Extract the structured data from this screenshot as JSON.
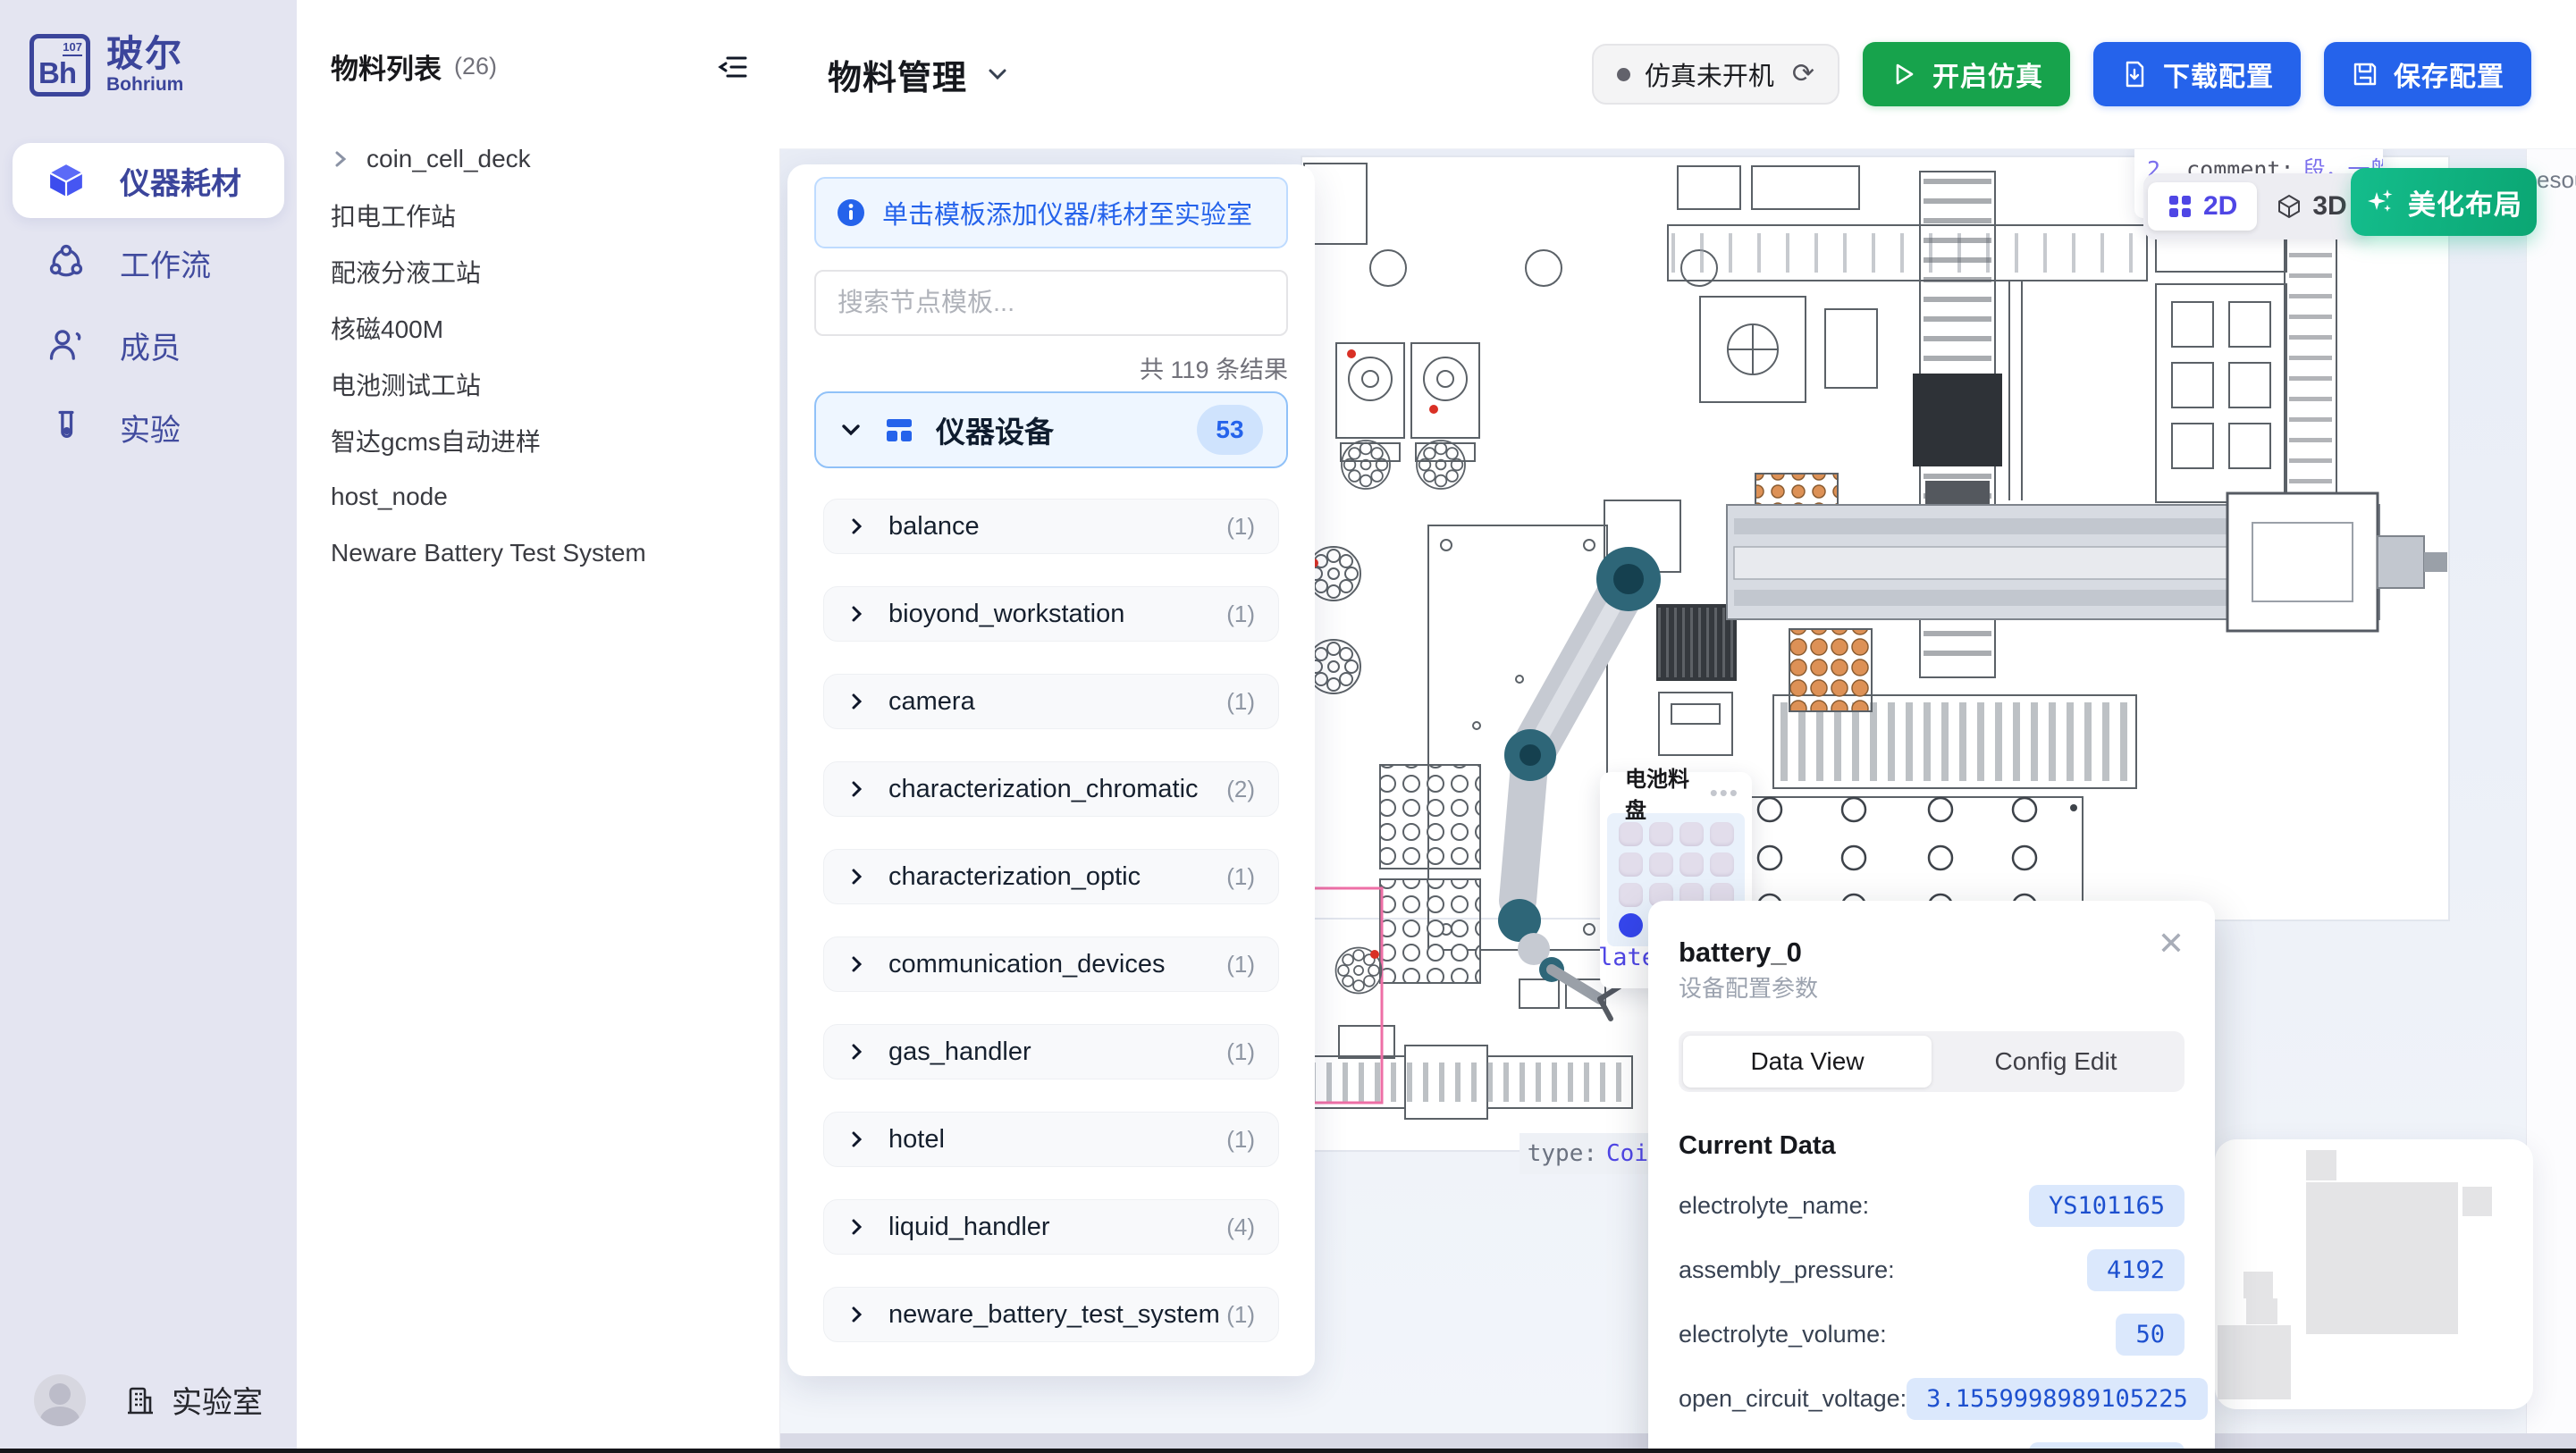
{
  "sidebar": {
    "logo": {
      "symbol": "Bh",
      "number": "107",
      "name_zh": "玻尔",
      "name_en": "Bohrium"
    },
    "items": [
      {
        "label": "仪器耗材",
        "active": true
      },
      {
        "label": "工作流",
        "active": false
      },
      {
        "label": "成员",
        "active": false
      },
      {
        "label": "实验",
        "active": false
      }
    ],
    "footer": {
      "lab_label": "实验室"
    }
  },
  "materials": {
    "title": "物料列表",
    "count": "(26)",
    "items": [
      {
        "label": "coin_cell_deck",
        "expandable": true
      },
      {
        "label": "扣电工作站",
        "expandable": false
      },
      {
        "label": "配液分液工站",
        "expandable": false
      },
      {
        "label": "核磁400M",
        "expandable": false
      },
      {
        "label": "电池测试工站",
        "expandable": false
      },
      {
        "label": "智达gcms自动进样",
        "expandable": false
      },
      {
        "label": "host_node",
        "expandable": false
      },
      {
        "label": "Neware Battery Test System",
        "expandable": false
      }
    ]
  },
  "header": {
    "title": "物料管理",
    "sim_status": "仿真未开机",
    "refresh_glyph": "⟳",
    "start_sim": "开启仿真",
    "download_config": "下载配置",
    "save_config": "保存配置"
  },
  "template_panel": {
    "hint": "单击模板添加仪器/耗材至实验室",
    "search_placeholder": "搜索节点模板...",
    "result_count": "共 119 条结果",
    "group": {
      "label": "仪器设备",
      "count": "53"
    },
    "categories": [
      {
        "name": "balance",
        "count": "(1)"
      },
      {
        "name": "bioyond_workstation",
        "count": "(1)"
      },
      {
        "name": "camera",
        "count": "(1)"
      },
      {
        "name": "characterization_chromatic",
        "count": "(2)"
      },
      {
        "name": "characterization_optic",
        "count": "(1)"
      },
      {
        "name": "communication_devices",
        "count": "(1)"
      },
      {
        "name": "gas_handler",
        "count": "(1)"
      },
      {
        "name": "hotel",
        "count": "(1)"
      },
      {
        "name": "liquid_handler",
        "count": "(4)"
      },
      {
        "name": "neware_battery_test_system",
        "count": "(1)"
      }
    ]
  },
  "canvas": {
    "comment_fragment": {
      "prefix": "2",
      "key": "_comment:",
      "value": "段，一般为空，stat"
    },
    "right_edge_fragment": "esou",
    "view_2d": "2D",
    "view_3d": "3D",
    "beautify": "美化布局",
    "tray": {
      "title": "电池料盘",
      "menu_glyph": "•••",
      "rows": 4,
      "cols": 4,
      "selected_index": 12
    },
    "plate_fragment": "late",
    "type_fragment": {
      "key": "type:",
      "value": "Coi"
    }
  },
  "popup": {
    "title": "battery_0",
    "subtitle": "设备配置参数",
    "close_glyph": "✕",
    "tabs": [
      {
        "label": "Data View",
        "active": true
      },
      {
        "label": "Config Edit",
        "active": false
      }
    ],
    "section": "Current Data",
    "fields": [
      {
        "label": "electrolyte_name:",
        "value": "YS101165"
      },
      {
        "label": "assembly_pressure:",
        "value": "4192"
      },
      {
        "label": "electrolyte_volume:",
        "value": "50"
      },
      {
        "label": "open_circuit_voltage:",
        "value": "3.1559998989105225"
      },
      {
        "label": "data_electrolyte_code:",
        "value": "LG000014"
      }
    ]
  },
  "colors": {
    "brand_indigo": "#3b459b",
    "accent_blue": "#2563eb",
    "green": "#17a34c",
    "beautify_green": "#10b981",
    "selected_slot_blue": "#3546ed",
    "value_pill_bg": "#dbe8fc",
    "value_text": "#1d50cf",
    "sidebar_bg": "#e4e5f1",
    "canvas_bg": "#edf1f8"
  }
}
